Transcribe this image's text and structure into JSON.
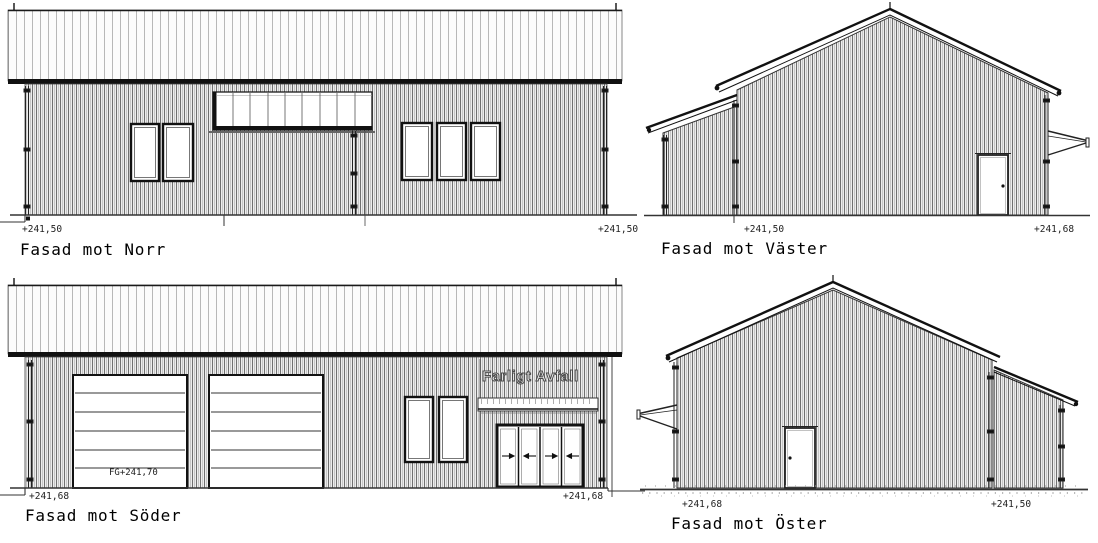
{
  "sheet": {
    "type": "facade-elevation-drawings",
    "colors": {
      "line": "#1a1a1a",
      "siding_dark": "#707070",
      "siding_light": "#bdbdbd",
      "wall_bg": "#ededed",
      "roof_bg": "#fcfcfc",
      "roof_seam": "#b8b8b8",
      "ground": "#333333"
    }
  },
  "elevations": {
    "north": {
      "title": "Fasad mot Norr",
      "elev_left": "+241,50",
      "elev_right": "+241,50"
    },
    "west": {
      "title": "Fasad mot Väster",
      "elev_left": "+241,50",
      "elev_right": "+241,68"
    },
    "south": {
      "title": "Fasad mot Söder",
      "elev_left": "+241,68",
      "elev_right": "+241,68",
      "sign_text": "Farligt Avfall",
      "floor_level_label": "FG+241,70"
    },
    "east": {
      "title": "Fasad mot Öster",
      "elev_left": "+241,68",
      "elev_right": "+241,50"
    }
  }
}
